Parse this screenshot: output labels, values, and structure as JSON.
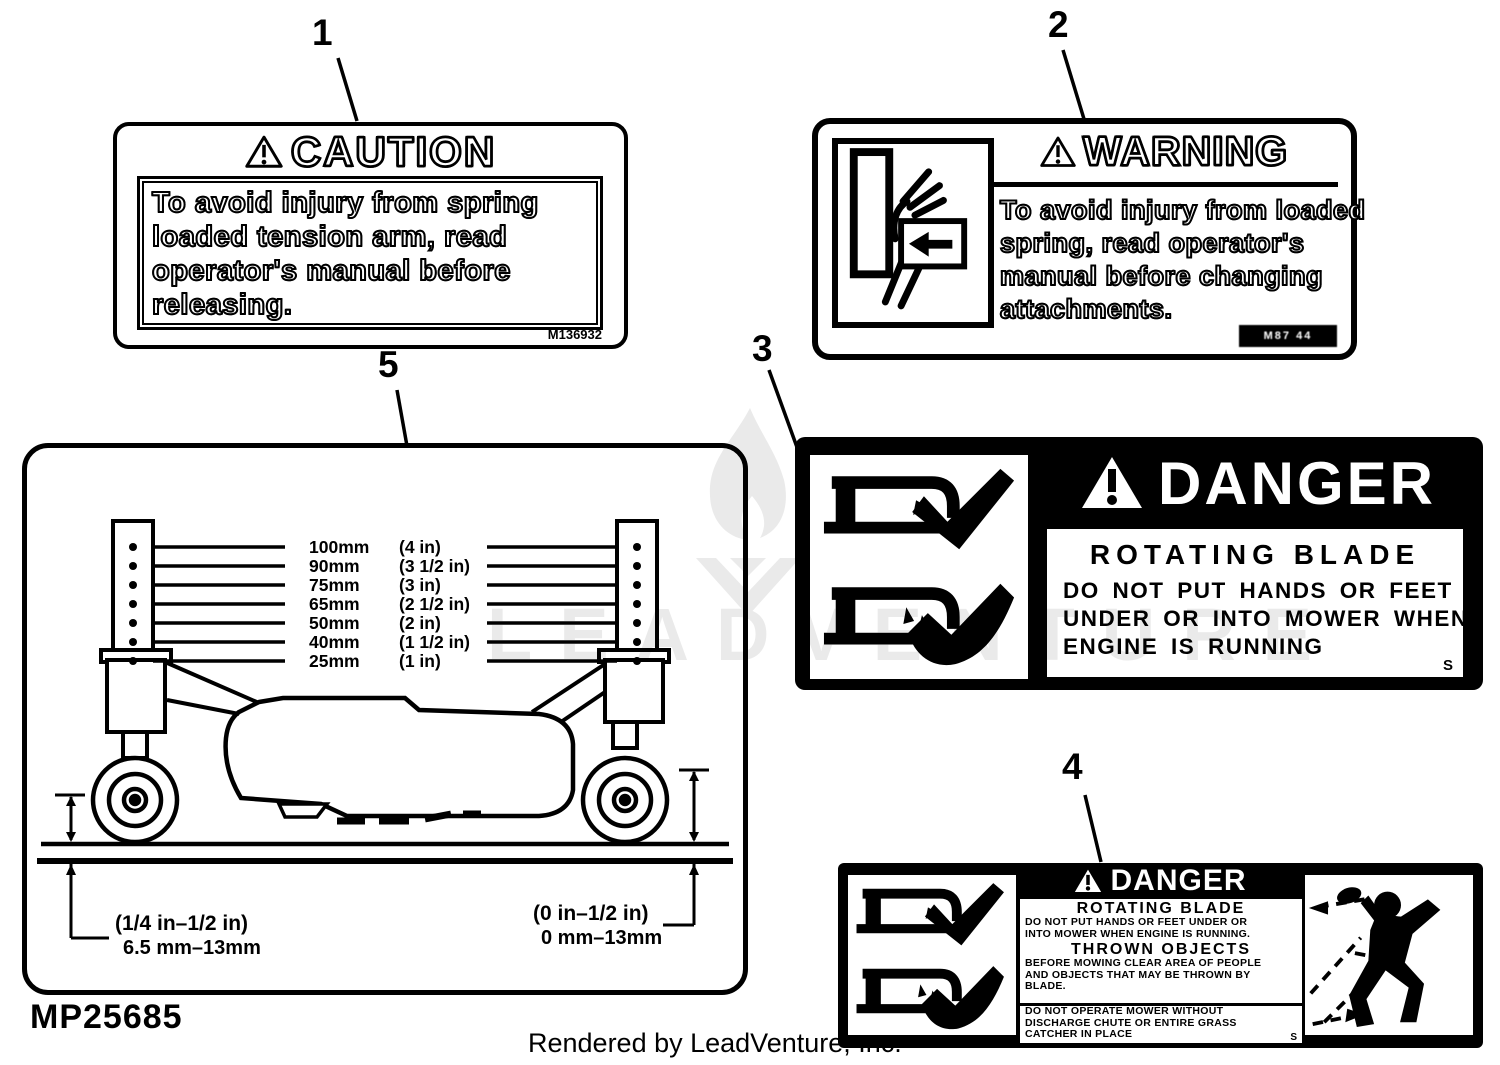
{
  "callouts": {
    "c1": "1",
    "c2": "2",
    "c3": "3",
    "c4": "4",
    "c5": "5"
  },
  "label1": {
    "header": "CAUTION",
    "lines": [
      "To avoid injury from spring",
      "loaded tension arm, read",
      "operator's manual before",
      "releasing."
    ],
    "code": "M136932"
  },
  "label2": {
    "header": "WARNING",
    "lines": [
      "To avoid injury from loaded",
      "spring, read operator's",
      "manual before changing",
      "attachments."
    ],
    "code": "M87 44"
  },
  "label3": {
    "header": "DANGER",
    "title": "ROTATING BLADE",
    "lines": [
      "DO NOT PUT HANDS OR FEET",
      "UNDER OR INTO MOWER WHEN",
      "ENGINE IS RUNNING"
    ],
    "corner": "S"
  },
  "label4": {
    "header": "DANGER",
    "s1_title": "ROTATING BLADE",
    "s1_lines": [
      "DO NOT PUT HANDS OR FEET UNDER OR",
      "INTO MOWER WHEN ENGINE IS RUNNING."
    ],
    "s2_title": "THROWN OBJECTS",
    "s2_lines": [
      "BEFORE MOWING CLEAR AREA OF PEOPLE",
      "AND OBJECTS THAT MAY BE THROWN BY",
      "BLADE."
    ],
    "s3_lines": [
      "DO NOT OPERATE MOWER WITHOUT",
      "DISCHARGE CHUTE OR ENTIRE GRASS",
      "CATCHER IN PLACE"
    ],
    "corner": "S"
  },
  "diagram5": {
    "rows": [
      {
        "mm": "100mm",
        "in": "(4 in)"
      },
      {
        "mm": "90mm",
        "in": "(3 1/2 in)"
      },
      {
        "mm": "75mm",
        "in": "(3 in)"
      },
      {
        "mm": "65mm",
        "in": "(2 1/2 in)"
      },
      {
        "mm": "50mm",
        "in": "(2 in)"
      },
      {
        "mm": "40mm",
        "in": "(1 1/2 in)"
      },
      {
        "mm": "25mm",
        "in": "(1 in)"
      }
    ],
    "left_dim_line1": "(1/4 in–1/2 in)",
    "left_dim_line2": "6.5 mm–13mm",
    "right_dim_line1": "(0 in–1/2 in)",
    "right_dim_line2": "0 mm–13mm"
  },
  "part_number": "MP25685",
  "footer": "Rendered by LeadVenture, Inc.",
  "watermark": "LEADVENTURE",
  "colors": {
    "ink": "#000000",
    "paper": "#ffffff",
    "watermark": "#eaeaea"
  }
}
